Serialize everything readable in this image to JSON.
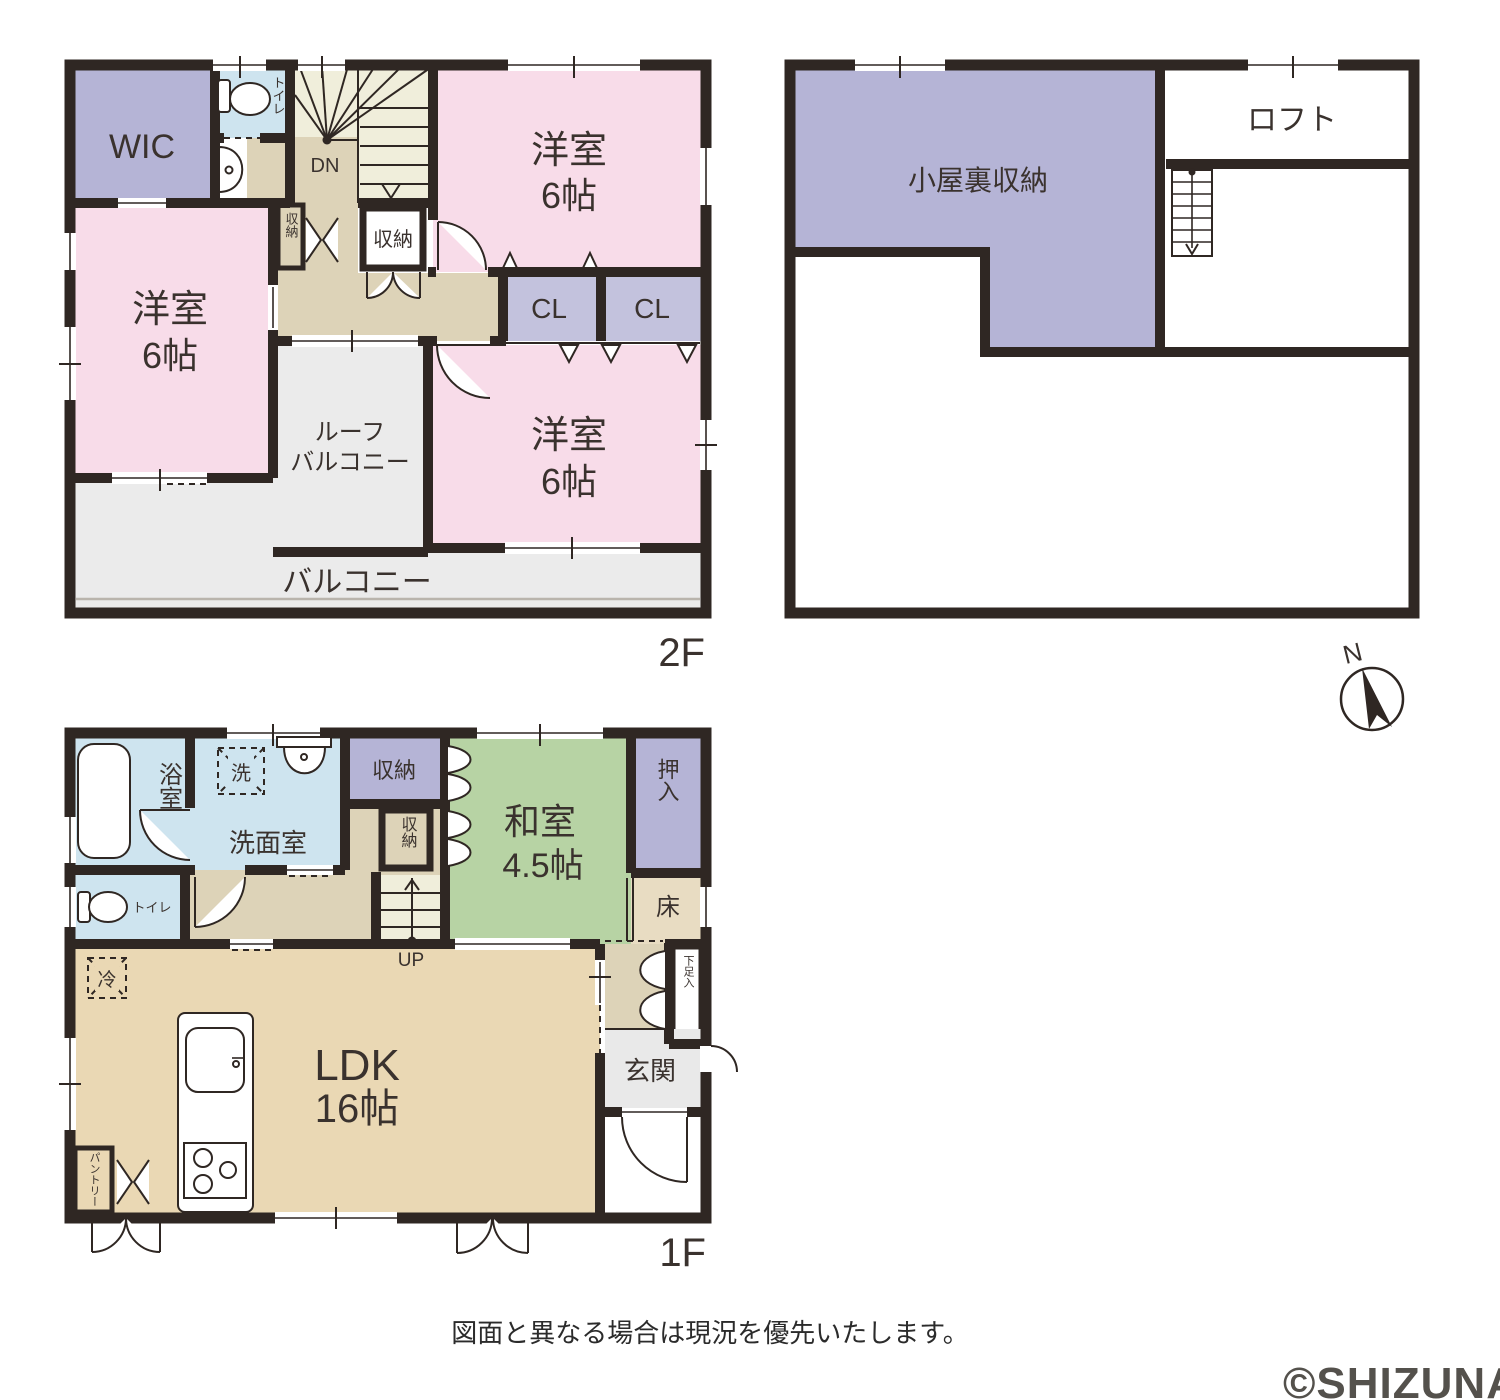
{
  "colors": {
    "wall": "#2f2723",
    "room_pink": "#f8dce9",
    "room_purple": "#b5b4d6",
    "room_closet_cl": "#c3c2dd",
    "room_lightblue": "#cee4ef",
    "room_green": "#b7d3a4",
    "hall_tan": "#ddd3b8",
    "ldk_tan": "#ead8b4",
    "stairs_cream": "#f0eedb",
    "balcony_gray": "#ebebeb",
    "toko_beige": "#e8dcc2"
  },
  "floor2": {
    "floor_label": "2F",
    "wic": "WIC",
    "toilet": "トイレ",
    "stairs_dn": "DN",
    "closet_small": "収納",
    "closet": "収納",
    "bedroom_ne": {
      "name": "洋室",
      "size": "6帖"
    },
    "cl_left": "CL",
    "cl_right": "CL",
    "bedroom_west": {
      "name": "洋室",
      "size": "6帖"
    },
    "bedroom_se": {
      "name": "洋室",
      "size": "6帖"
    },
    "roof_balcony": {
      "line1": "ルーフ",
      "line2": "バルコニー"
    },
    "balcony": "バルコニー"
  },
  "attic": {
    "storage": "小屋裏収納",
    "loft": "ロフト"
  },
  "compass": {
    "north": "N"
  },
  "floor1": {
    "floor_label": "1F",
    "bath": "浴室",
    "washer": "洗",
    "washroom": "洗面室",
    "closet_upper": "収納",
    "closet_lower": "収納",
    "toilet": "トイレ",
    "stairs_up": "UP",
    "washitsu": {
      "name": "和室",
      "size": "4.5帖"
    },
    "oshiire": "押入",
    "toko": "床",
    "fridge": "冷",
    "ldk": {
      "name": "LDK",
      "size": "16帖"
    },
    "pantry": "パントリー",
    "shoe_cabinet": "下足入",
    "genkan": "玄関"
  },
  "footer": {
    "note": "図面と異なる場合は現況を優先いたします。"
  },
  "watermark": "©SHIZUNAVI"
}
